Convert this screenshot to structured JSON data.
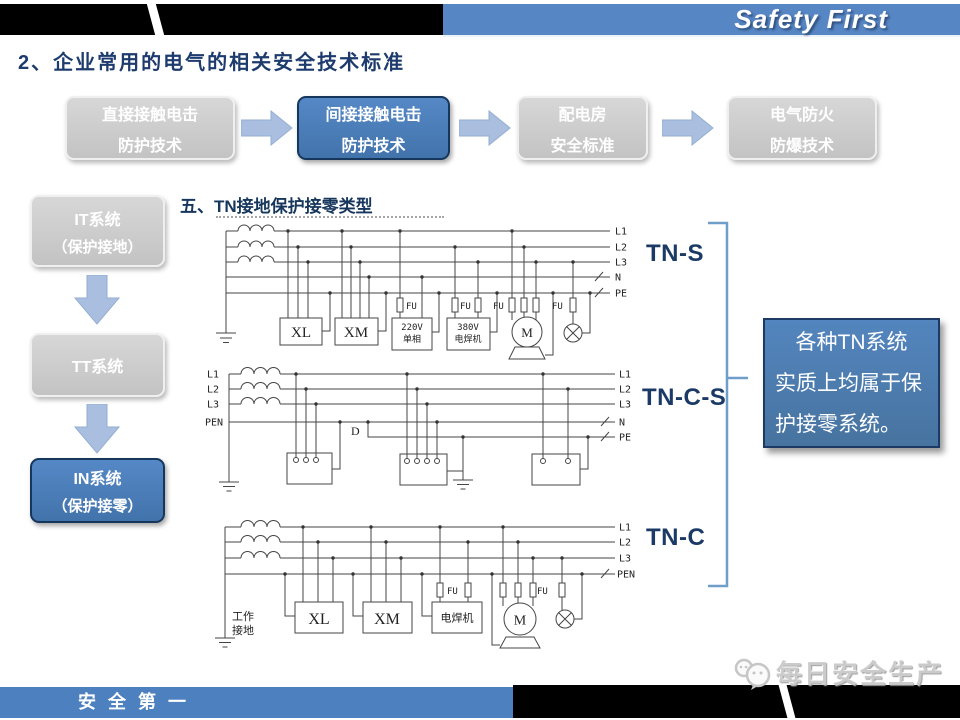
{
  "header": {
    "brand": "Safety First"
  },
  "page_title": "2、企业常用的电气的相关安全技术标准",
  "flow_boxes": [
    {
      "line1": "直接接触电击",
      "line2": "防护技术"
    },
    {
      "line1": "间接接触电击",
      "line2": "防护技术"
    },
    {
      "line1": "配电房",
      "line2": "安全标准"
    },
    {
      "line1": "电气防火",
      "line2": "防爆技术"
    }
  ],
  "side_boxes": [
    {
      "line1": "IT系统",
      "line2": "（保护接地）"
    },
    {
      "line1": "TT系统"
    },
    {
      "line1": "IN系统",
      "line2": "（保护接零）"
    }
  ],
  "section_heading": "五、TN接地保护接零类型",
  "diagram_tns": {
    "label": "TN-S",
    "lines": {
      "l1": "L1",
      "l2": "L2",
      "l3": "L3",
      "n": "N",
      "pe": "PE"
    },
    "fu": "FU",
    "xl": "XL",
    "xm": "XM",
    "box220_line1": "220V",
    "box220_line2": "单相",
    "box380_line1": "380V",
    "box380_line2": "电焊机",
    "motor": "M"
  },
  "diagram_tncs": {
    "label": "TN-C-S",
    "left": {
      "l1": "L1",
      "l2": "L2",
      "l3": "L3",
      "pen": "PEN"
    },
    "right": {
      "l1": "L1",
      "l2": "L2",
      "l3": "L3",
      "n": "N",
      "pe": "PE"
    },
    "d": "D"
  },
  "diagram_tnc": {
    "label": "TN-C",
    "lines": {
      "l1": "L1",
      "l2": "L2",
      "l3": "L3",
      "pen": "PEN"
    },
    "fu": "FU",
    "xl": "XL",
    "xm": "XM",
    "welder": "电焊机",
    "motor": "M",
    "ground_label_line1": "工作",
    "ground_label_line2": "接地"
  },
  "callout": {
    "lines": [
      "各种TN系统",
      "实质上均属于保",
      "护接零系统。"
    ]
  },
  "footer": {
    "slogan": "安全第一",
    "watermark": "每日安全生产"
  }
}
